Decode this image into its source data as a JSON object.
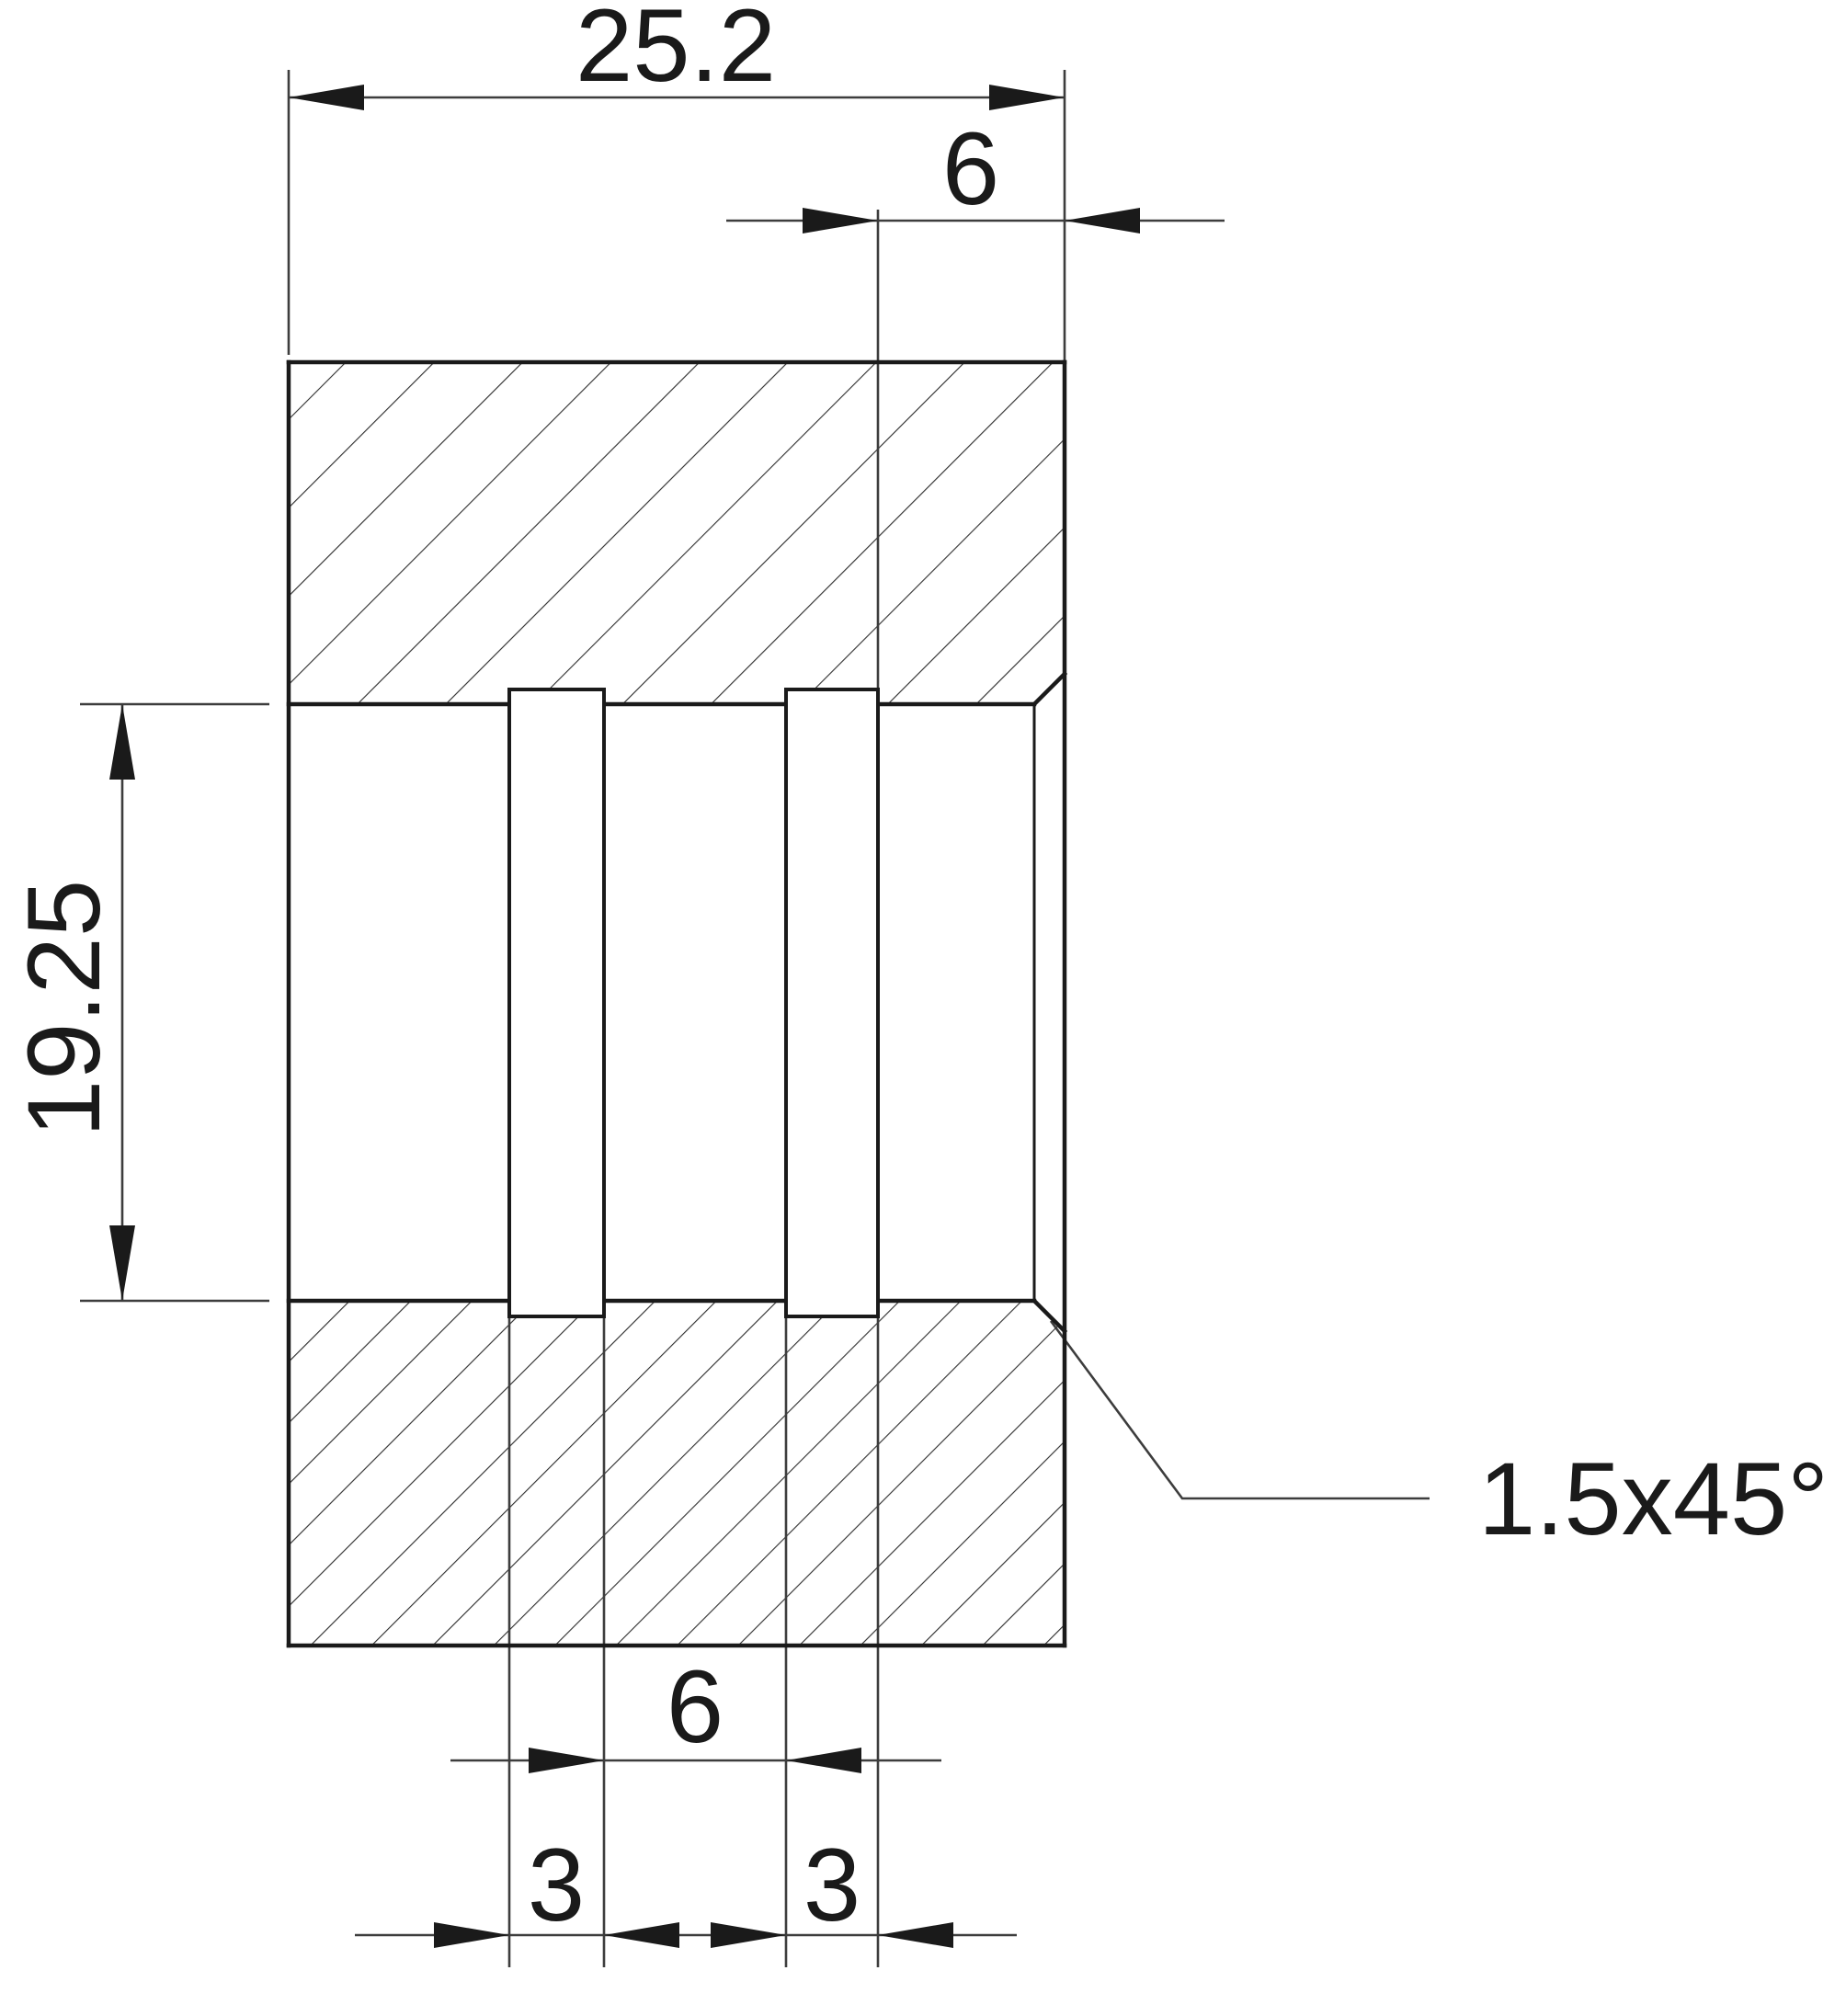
{
  "drawing": {
    "title": "sectioned-bushing-technical-drawing",
    "colors": {
      "background": "#ffffff",
      "outline": "#1a1a1a",
      "thin_line": "#3d3d3d",
      "hatch": "#2e2e2e",
      "arrow": "#1a1a1a",
      "text": "#1a1a1a",
      "groove_fill": "#ffffff"
    },
    "dimensions": {
      "overall_width": "25.2",
      "right_bore_offset": "6",
      "bore_height": "19.25",
      "groove_gap": "6",
      "groove_width_left": "3",
      "groove_width_right": "3",
      "chamfer_note": "1.5x45°"
    }
  }
}
